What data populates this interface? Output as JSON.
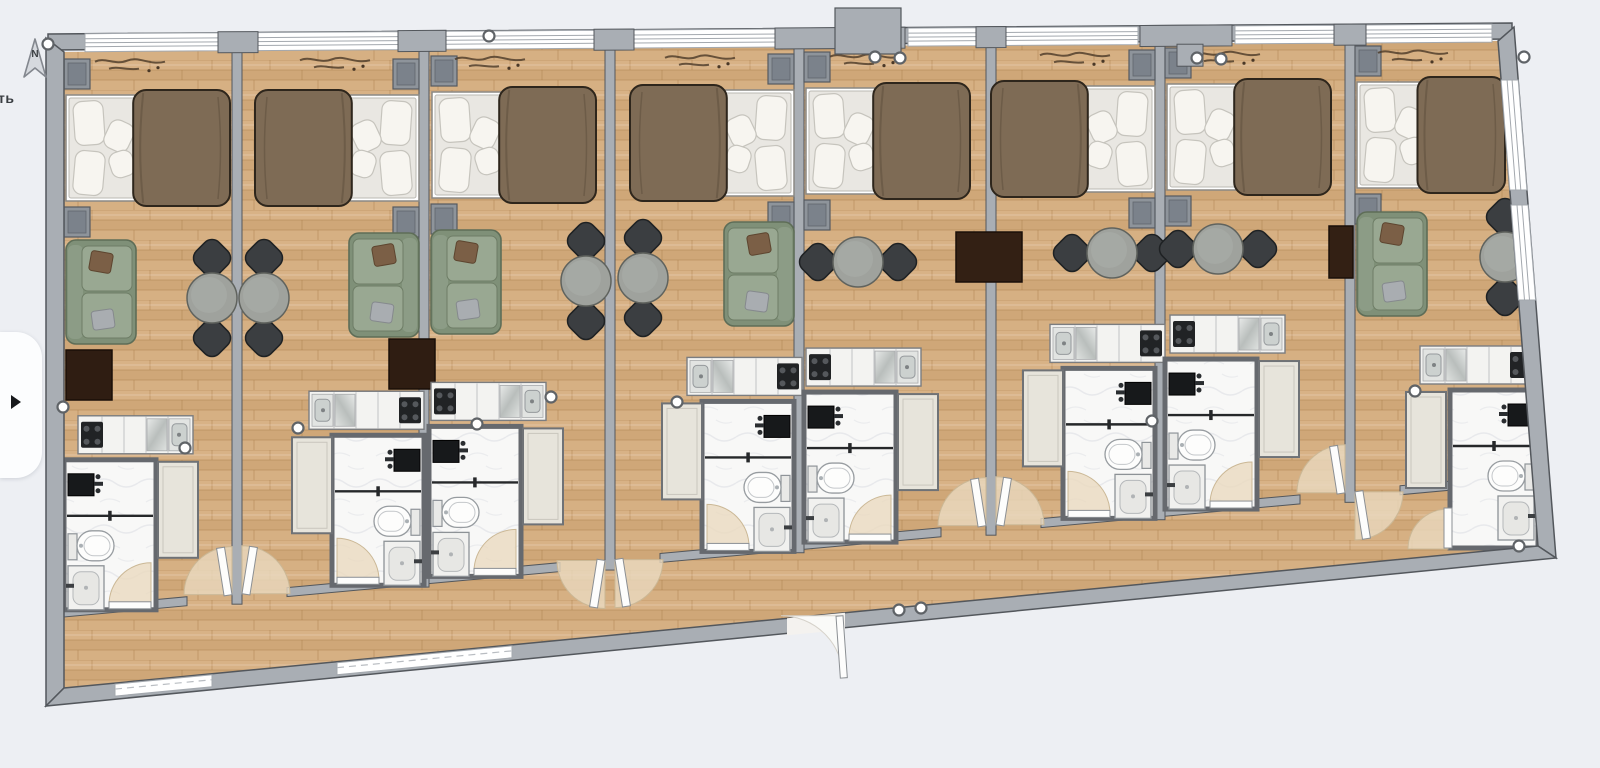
{
  "app": {
    "title": "Hotel rooms floor plan",
    "background": "#edeff3"
  },
  "compass": {
    "label": "N"
  },
  "left_edge": {
    "clipped_text": "ть",
    "panel_toggle_icon": "open-panel"
  },
  "scene": {
    "type": "floor-plan",
    "room_count": 8,
    "corridor": "along bottom",
    "main_entrance": "bottom center"
  },
  "colors": {
    "page_bg": "#edeff3",
    "wall": "#a9aeb4",
    "wall_stroke": "#53575c",
    "wood": "#d4ad7f",
    "wood_line": "#a87c4a",
    "bath_floor": "#f8f8f7",
    "window": "#ffffff",
    "window_line": "#a3a8ae",
    "fan": "#ead9bf",
    "fan_stroke": "#cbb896",
    "sofa": "#8c9c86",
    "sofa_dark": "#5e6d57",
    "sofa_cushion": "#99a892",
    "blanket": "#7e6b55",
    "blanket_stroke": "#2e261c",
    "mattress": "#e9e7e2",
    "pillow": "#f7f5f0",
    "nightstand": "#8e949b",
    "chair": "#3b3e41",
    "table": "#9fa29d",
    "tv": "#332014",
    "wardrobe": "#e7e4db",
    "counter": "#f3f3f1",
    "cooktop": "#212325",
    "steel": "#ccd1cf",
    "fixture_dark": "#17191b",
    "handle_stroke": "#5f6367",
    "decor": "#4a3827"
  },
  "building": {
    "outer": [
      [
        46,
        38
      ],
      [
        1514,
        27
      ],
      [
        1556,
        558
      ],
      [
        46,
        706
      ]
    ],
    "top": {
      "x1": 48,
      "y1": 40,
      "x2": 1512,
      "y2": 30
    },
    "corridor": {
      "x1": 64,
      "y1": 610,
      "x2": 1452,
      "y2": 483
    },
    "bottom_inner": {
      "x1": 64,
      "y1": 688,
      "x2": 1538,
      "y2": 546
    },
    "partitions": [
      237,
      424,
      610,
      799,
      991,
      1160,
      1350
    ],
    "top_windows": [
      [
        85,
        218
      ],
      [
        256,
        400
      ],
      [
        446,
        596
      ],
      [
        632,
        824
      ],
      [
        908,
        978
      ],
      [
        1004,
        1138
      ],
      [
        1235,
        1336
      ],
      [
        1364,
        1492
      ]
    ],
    "top_blocks": [
      [
        218,
        258
      ],
      [
        398,
        446
      ],
      [
        594,
        634
      ],
      [
        775,
        905
      ],
      [
        976,
        1006
      ],
      [
        1140,
        1232
      ],
      [
        1334,
        1366
      ]
    ],
    "column": {
      "x": 835,
      "w": 66,
      "y": 8,
      "h": 46
    },
    "bottom_windows": [
      [
        115,
        212
      ],
      [
        337,
        512
      ]
    ],
    "right_windows": [
      [
        80,
        190
      ],
      [
        205,
        300
      ]
    ],
    "entrance": {
      "x1": 787,
      "x2": 845
    },
    "corridor_segments": [
      [
        64,
        187
      ],
      [
        232,
        242
      ],
      [
        287,
        560
      ],
      [
        605,
        615
      ],
      [
        660,
        941
      ],
      [
        986,
        996
      ],
      [
        1041,
        1300
      ],
      [
        1345,
        1355
      ],
      [
        1400,
        1448
      ]
    ],
    "nook_wall": {
      "x": 1448,
      "y": 483,
      "h": 30
    }
  },
  "handles": [
    [
      48,
      44
    ],
    [
      63,
      407
    ],
    [
      185,
      448
    ],
    [
      298,
      428
    ],
    [
      477,
      424
    ],
    [
      551,
      397
    ],
    [
      489,
      36
    ],
    [
      677,
      402
    ],
    [
      875,
      57
    ],
    [
      900,
      58
    ],
    [
      899,
      610
    ],
    [
      921,
      608
    ],
    [
      1152,
      421
    ],
    [
      1197,
      58
    ],
    [
      1221,
      59
    ],
    [
      1415,
      391
    ],
    [
      1524,
      57
    ],
    [
      1519,
      546
    ]
  ],
  "rooms": [
    {
      "id": "room-1",
      "objects": [
        "double-bed",
        "nightstands",
        "sofa",
        "coffee-table",
        "dining-table-2-chairs",
        "kitchenette",
        "bathroom",
        "wardrobe"
      ],
      "bed": {
        "x": 66,
        "y": 95,
        "w": 160,
        "head": "left"
      },
      "ns_x": 64,
      "sofa": {
        "x": 66,
        "y": 240,
        "back": "left"
      },
      "small_table": {
        "x": 66,
        "y": 350
      },
      "tv": null,
      "dining": {
        "type": "v",
        "x": 212,
        "y": 298
      },
      "kitchen": {
        "x": 78,
        "mirror": false
      },
      "bath": {
        "x": 64,
        "side": "left",
        "center": 110
      },
      "wardrobe_x": 158,
      "entry": {
        "partition": 237,
        "dir": -1,
        "into": "room"
      },
      "decor_x": 95
    },
    {
      "id": "room-2",
      "objects": [
        "double-bed",
        "nightstands",
        "sofa",
        "coffee-table",
        "dining-table-2-chairs",
        "kitchenette",
        "bathroom",
        "wardrobe"
      ],
      "bed": {
        "x": 259,
        "y": 95,
        "w": 160,
        "head": "right"
      },
      "ns_x": 393,
      "sofa": {
        "x": 349,
        "y": 233,
        "back": "right"
      },
      "small_table": {
        "x": 389,
        "y": 339
      },
      "tv": null,
      "dining": {
        "type": "v",
        "x": 264,
        "y": 298
      },
      "kitchen": {
        "x": 309,
        "mirror": true
      },
      "bath": {
        "x": 332,
        "side": "right",
        "center": 378
      },
      "wardrobe_x": 292,
      "entry": {
        "partition": 237,
        "dir": 1,
        "into": "room"
      },
      "decor_x": 300
    },
    {
      "id": "room-3",
      "objects": [
        "double-bed",
        "nightstands",
        "sofa",
        "dining-table-2-chairs",
        "kitchenette",
        "bathroom",
        "wardrobe"
      ],
      "bed": {
        "x": 432,
        "y": 92,
        "w": 160,
        "head": "left"
      },
      "ns_x": 431,
      "sofa": {
        "x": 431,
        "y": 230,
        "back": "left"
      },
      "small_table": null,
      "tv": null,
      "dining": {
        "type": "v",
        "x": 586,
        "y": 281
      },
      "kitchen": {
        "x": 431,
        "mirror": false
      },
      "bath": {
        "x": 429,
        "side": "left",
        "center": 475
      },
      "wardrobe_x": 523,
      "entry": {
        "partition": 610,
        "dir": -1,
        "into": "corridor"
      },
      "decor_x": 455
    },
    {
      "id": "room-4",
      "objects": [
        "double-bed",
        "nightstands",
        "sofa",
        "dining-table-2-chairs",
        "kitchenette",
        "bathroom",
        "wardrobe"
      ],
      "bed": {
        "x": 634,
        "y": 90,
        "w": 160,
        "head": "right"
      },
      "ns_x": 768,
      "sofa": {
        "x": 724,
        "y": 222,
        "back": "right"
      },
      "small_table": null,
      "tv": null,
      "dining": {
        "type": "v",
        "x": 643,
        "y": 278
      },
      "kitchen": {
        "x": 687,
        "mirror": true
      },
      "bath": {
        "x": 702,
        "side": "right",
        "center": 748
      },
      "wardrobe_x": 662,
      "entry": {
        "partition": 610,
        "dir": 1,
        "into": "corridor"
      },
      "decor_x": 665
    },
    {
      "id": "room-5",
      "objects": [
        "double-bed",
        "nightstands",
        "tv-console",
        "dining-table-2-chairs",
        "kitchenette",
        "bathroom",
        "wardrobe"
      ],
      "bed": {
        "x": 806,
        "y": 88,
        "w": 160,
        "head": "left"
      },
      "ns_x": 804,
      "sofa": null,
      "small_table": null,
      "tv": {
        "x": 956,
        "y": 232,
        "w": 66,
        "h": 50
      },
      "dining": {
        "type": "h",
        "x": 858,
        "y": 262
      },
      "kitchen": {
        "x": 806,
        "mirror": false
      },
      "bath": {
        "x": 804,
        "side": "left",
        "center": 850
      },
      "wardrobe_x": 898,
      "entry": {
        "partition": 991,
        "dir": -1,
        "into": "room"
      },
      "decor_x": 830
    },
    {
      "id": "room-6",
      "objects": [
        "double-bed",
        "nightstands",
        "dining-table-2-chairs",
        "kitchenette",
        "bathroom",
        "wardrobe"
      ],
      "bed": {
        "x": 995,
        "y": 86,
        "w": 160,
        "head": "right"
      },
      "ns_x": 1129,
      "sofa": null,
      "small_table": null,
      "tv": null,
      "dining": {
        "type": "h",
        "x": 1112,
        "y": 253
      },
      "kitchen": {
        "x": 1050,
        "mirror": true
      },
      "bath": {
        "x": 1063,
        "side": "right",
        "center": 1109
      },
      "wardrobe_x": 1023,
      "entry": {
        "partition": 991,
        "dir": 1,
        "into": "room"
      },
      "decor_x": 1040
    },
    {
      "id": "room-7",
      "objects": [
        "double-bed",
        "nightstands",
        "tv-console",
        "dining-table-2-chairs",
        "kitchenette",
        "bathroom",
        "wardrobe"
      ],
      "bed": {
        "x": 1167,
        "y": 84,
        "w": 160,
        "head": "left"
      },
      "ns_x": 1165,
      "sofa": null,
      "small_table": null,
      "tv": {
        "x": 1329,
        "y": 226,
        "w": 24,
        "h": 52
      },
      "dining": {
        "type": "h",
        "x": 1218,
        "y": 249
      },
      "kitchen": {
        "x": 1170,
        "mirror": false
      },
      "bath": {
        "x": 1165,
        "side": "left",
        "center": 1211
      },
      "wardrobe_x": 1259,
      "entry": {
        "partition": 1350,
        "dir": -1,
        "into": "room"
      },
      "decor_x": 1190
    },
    {
      "id": "room-8",
      "objects": [
        "double-bed",
        "nightstands",
        "sofa",
        "dining-table-2-chairs",
        "kitchenette",
        "bathroom",
        "wardrobe"
      ],
      "bed": {
        "x": 1357,
        "y": 82,
        "w": 144,
        "head": "left"
      },
      "ns_x": 1355,
      "sofa": {
        "x": 1357,
        "y": 212,
        "back": "left"
      },
      "small_table": null,
      "tv": null,
      "dining": {
        "type": "v",
        "x": 1505,
        "y": 257
      },
      "kitchen": {
        "x": 1420,
        "mirror": true
      },
      "bath": {
        "x": 1450,
        "side": "right",
        "y": 390,
        "h": 158,
        "w": 88,
        "door": "west"
      },
      "wardrobe_x": 1406,
      "entry": {
        "partition": 1350,
        "dir": 1,
        "into": "corridor"
      },
      "decor_x": 1378
    }
  ]
}
